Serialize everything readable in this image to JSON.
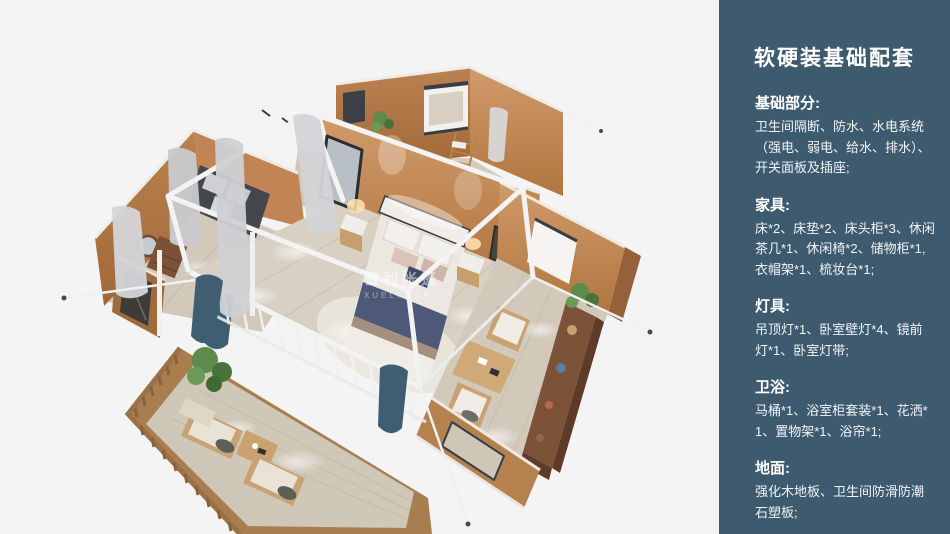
{
  "panel": {
    "title": "软硬装基础配套",
    "sections": [
      {
        "heading": "基础部分:",
        "body": "卫生间隔断、防水、水电系统（强电、弱电、给水、排水）、开关面板及插座;"
      },
      {
        "heading": "家具:",
        "body": "床*2、床垫*2、床头柜*3、休闲茶几*1、休闲椅*2、储物柜*1,衣帽架*1、梳妆台*1;"
      },
      {
        "heading": "灯具:",
        "body": "吊顶灯*1、卧室壁灯*4、镜前灯*1、卧室灯带;"
      },
      {
        "heading": "卫浴:",
        "body": "马桶*1、浴室柜套装*1、花洒*1、置物架*1、浴帘*1;"
      },
      {
        "heading": "地面:",
        "body": "强化木地板、卫生间防滑防潮石塑板;"
      }
    ]
  },
  "illustration": {
    "watermark": {
      "line1": "雪利帐篷",
      "line2": "XUELI TENT"
    }
  },
  "colors": {
    "panel_bg": "#3d5a6e",
    "panel_text": "#f2f5f7",
    "canvas_bg": "#f4f4f5",
    "wall_tan": "#b97e4c",
    "wall_lit": "#cd9263",
    "floor_wood": "#d6cec1",
    "deck_wood": "#a87e50",
    "frame_white": "#f3f3f4",
    "bedding_navy": "#4d5977",
    "curtain_teal": "#3f5e72",
    "plant_green": "#5f8f4e"
  }
}
